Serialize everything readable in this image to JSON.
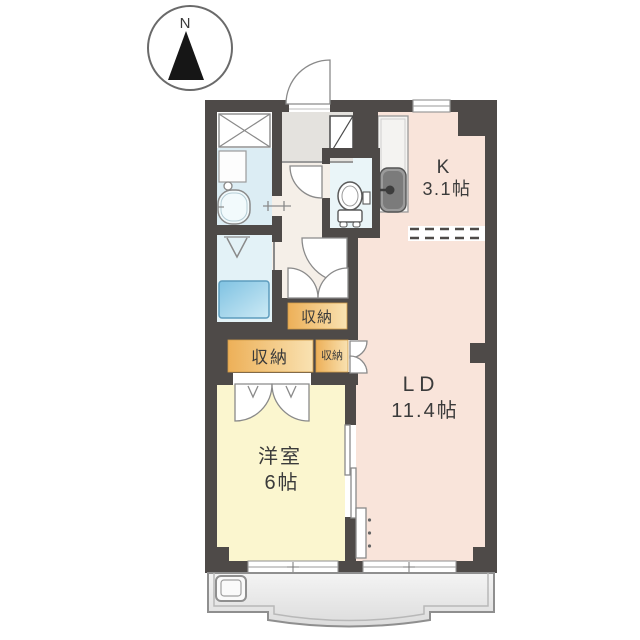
{
  "compass": {
    "north_label": "N"
  },
  "rooms": {
    "kitchen": {
      "name": "K",
      "area": "3.1帖"
    },
    "living_dining": {
      "name": "LD",
      "area": "11.4帖"
    },
    "western_room": {
      "name": "洋室",
      "area": "6帖"
    }
  },
  "closets": {
    "hall_closet": {
      "label": "収納"
    },
    "bedroom_closet": {
      "label": "収納"
    },
    "ld_closet": {
      "label": "収納"
    }
  },
  "colors": {
    "wall": "#4e4a48",
    "living_dining_kitchen": "#f9e4da",
    "western_room": "#fbf6cf",
    "bathroom": "#dcedf4",
    "washroom": "#e3f2f7",
    "toilet": "#eaf5f8",
    "hall": "#f5efe8",
    "closet_orange": "#edb058",
    "washer_pan_blue": "#7fc2e2",
    "balcony": "#e9e9e9"
  }
}
